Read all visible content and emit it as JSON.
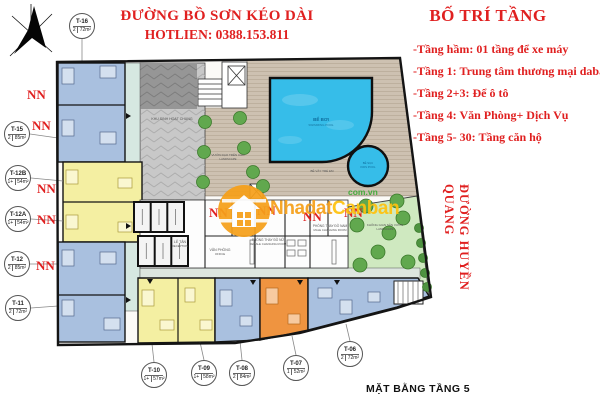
{
  "titles": {
    "street_top": "ĐƯỜNG BỒ SƠN KÉO DÀI",
    "hotline": "HOTLIEN: 0388.153.811",
    "street_right": "ĐƯỜNG HUYỀN QUANG",
    "caption": "MẶT BẰNG TẦNG 5"
  },
  "legend": {
    "title": "BỐ TRÍ TẦNG",
    "items": [
      "-Tầng hầm: 01 tầng để xe máy",
      "-Tầng 1: Trung tâm thương mại dabaco",
      "-Tầng 2+3: Để ô tô",
      "-Tầng 4: Văn Phòng+ Dịch Vụ",
      "-Tầng 5- 30: Tầng căn hộ"
    ]
  },
  "watermark": {
    "part1": "Nhadat",
    "part2": "Canban",
    "domain": "com.vn"
  },
  "plan": {
    "nn_text": "NN",
    "nn_positions": [
      {
        "x": 27,
        "y": 88
      },
      {
        "x": 32,
        "y": 119
      },
      {
        "x": 37,
        "y": 182
      },
      {
        "x": 37,
        "y": 213
      },
      {
        "x": 36,
        "y": 259
      },
      {
        "x": 209,
        "y": 206
      },
      {
        "x": 257,
        "y": 204
      },
      {
        "x": 303,
        "y": 210
      },
      {
        "x": 344,
        "y": 206
      }
    ],
    "units": [
      {
        "id": "T-16",
        "beds": "2",
        "area": "72m²",
        "x": 82,
        "y": 26,
        "lx1": 82,
        "ly1": 39,
        "lx2": 82,
        "ly2": 62
      },
      {
        "id": "T-15",
        "beds": "2",
        "area": "85m²",
        "x": 17,
        "y": 134,
        "lx1": 30,
        "ly1": 134,
        "lx2": 58,
        "ly2": 138
      },
      {
        "id": "T-12B",
        "beds": "1+",
        "area": "54m²",
        "x": 18,
        "y": 178,
        "lx1": 31,
        "ly1": 178,
        "lx2": 63,
        "ly2": 181
      },
      {
        "id": "T-12A",
        "beds": "1+",
        "area": "54m²",
        "x": 18,
        "y": 219,
        "lx1": 31,
        "ly1": 219,
        "lx2": 63,
        "ly2": 221
      },
      {
        "id": "T-12",
        "beds": "2",
        "area": "85m²",
        "x": 17,
        "y": 264,
        "lx1": 30,
        "ly1": 264,
        "lx2": 58,
        "ly2": 264
      },
      {
        "id": "T-11",
        "beds": "2",
        "area": "72m²",
        "x": 18,
        "y": 308,
        "lx1": 31,
        "ly1": 308,
        "lx2": 58,
        "ly2": 306
      },
      {
        "id": "T-10",
        "beds": "1+",
        "area": "57m²",
        "x": 154,
        "y": 375,
        "lx1": 154,
        "ly1": 362,
        "lx2": 152,
        "ly2": 344
      },
      {
        "id": "T-09",
        "beds": "1+",
        "area": "58m²",
        "x": 204,
        "y": 373,
        "lx1": 204,
        "ly1": 360,
        "lx2": 200,
        "ly2": 342
      },
      {
        "id": "T-08",
        "beds": "2",
        "area": "84m²",
        "x": 242,
        "y": 373,
        "lx1": 242,
        "ly1": 360,
        "lx2": 240,
        "ly2": 341
      },
      {
        "id": "T-07",
        "beds": "1",
        "area": "52m²",
        "x": 296,
        "y": 368,
        "lx1": 296,
        "ly1": 355,
        "lx2": 292,
        "ly2": 336
      },
      {
        "id": "T-06",
        "beds": "2",
        "area": "72m²",
        "x": 350,
        "y": 354,
        "lx1": 350,
        "ly1": 341,
        "lx2": 346,
        "ly2": 324
      }
    ],
    "rooms": {
      "community": "KHU SINH HOẠT CHUNG",
      "deck_garden1": "VƯỜN DẠO TRÊN CAO",
      "deck_garden2": "LANDSCAPE",
      "pool1": "BỂ BƠI",
      "pool2": "SWIMMING POOL",
      "kids1": "BỂ SỤC",
      "kids2": "KIDS POOL",
      "wading": "BỂ VẦY TRẺ EM",
      "garden1": "KHÔNG GIAN SÂN VƯỜN",
      "garden2": "LANDSCAPE",
      "reception1": "LỄ TÂN",
      "reception2": "RECEPTION",
      "office1": "VĂN PHÒNG",
      "office2": "OFFICE",
      "changing_male1": "PHÒNG THAY ĐỒ NAM",
      "changing_male2": "MALE CHANGING ROOM",
      "changing_female1": "PHÒNG THAY ĐỒ NỮ",
      "changing_female2": "FEMALE CHANGING ROOM"
    },
    "trees": {
      "deck": [
        {
          "x": 205,
          "y": 122
        },
        {
          "x": 204,
          "y": 152
        },
        {
          "x": 203,
          "y": 182
        },
        {
          "x": 240,
          "y": 118
        },
        {
          "x": 244,
          "y": 148
        },
        {
          "x": 253,
          "y": 172
        },
        {
          "x": 263,
          "y": 186
        }
      ],
      "garden": [
        {
          "x": 357,
          "y": 225
        },
        {
          "x": 403,
          "y": 218
        },
        {
          "x": 378,
          "y": 252
        },
        {
          "x": 360,
          "y": 265
        },
        {
          "x": 408,
          "y": 262
        },
        {
          "x": 389,
          "y": 233
        },
        {
          "x": 366,
          "y": 206
        },
        {
          "x": 397,
          "y": 201
        }
      ],
      "bushes": [
        {
          "x": 419,
          "y": 228
        },
        {
          "x": 421,
          "y": 243
        },
        {
          "x": 423,
          "y": 258
        },
        {
          "x": 425,
          "y": 273
        },
        {
          "x": 427,
          "y": 287
        }
      ]
    }
  },
  "colors": {
    "red": "#e02020",
    "unit_blue": "#a9c0df",
    "unit_yellow": "#f4efa2",
    "unit_orange": "#ef9440",
    "corridor": "#d6e8e1",
    "deck": "#cdc1b1",
    "garden": "#cfe9c0",
    "gray_area": "#c8c8c8",
    "pool": "#36bde9",
    "tree": "#61a84e",
    "watermark_orange": "#f6a01a",
    "watermark_yellow": "#ffc20e",
    "watermark_green": "#3aaa35",
    "wall": "#141414"
  }
}
